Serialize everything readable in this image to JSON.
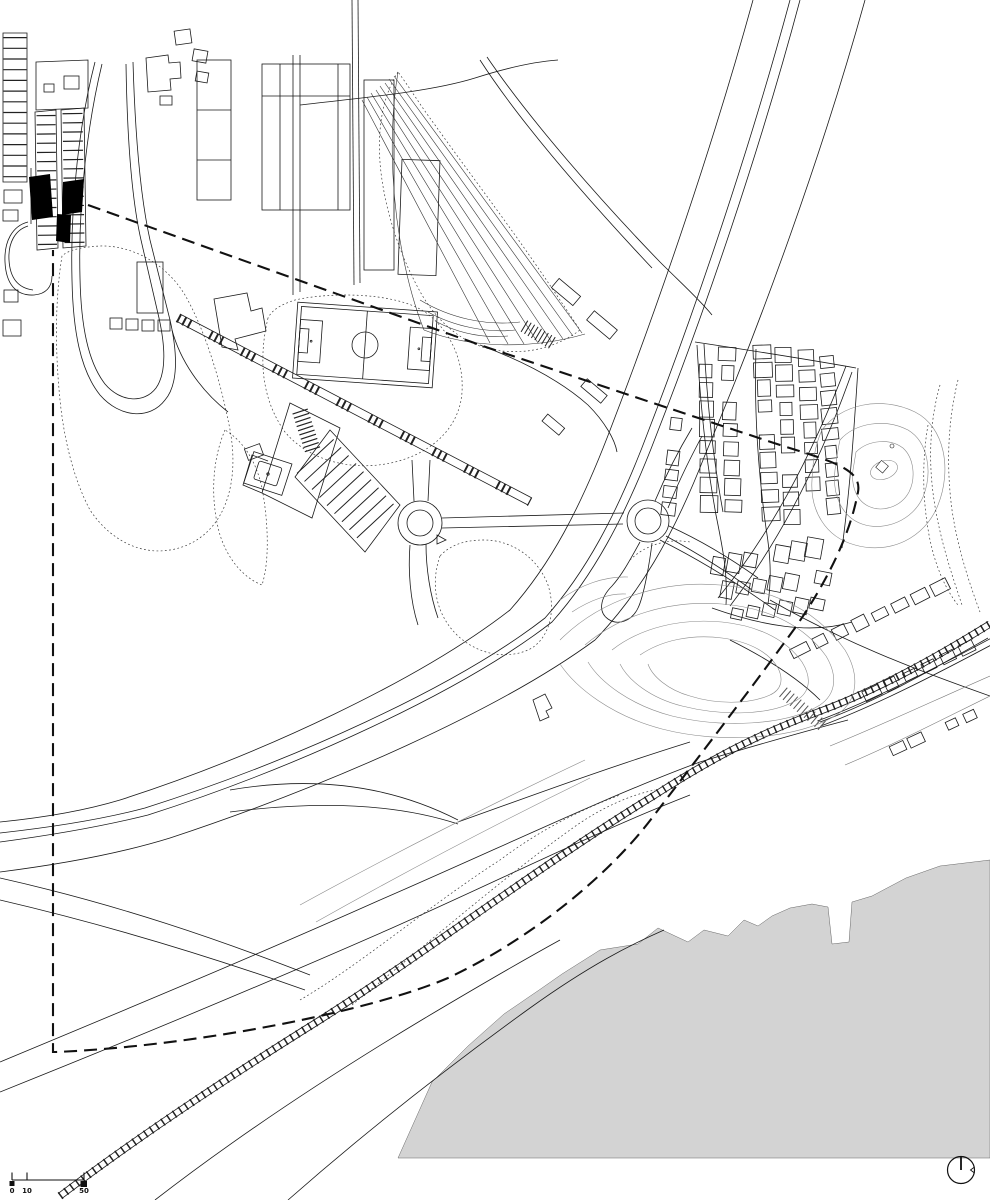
{
  "drawing": {
    "kind": "architectural urban site plan",
    "colors": {
      "background": "#ffffff",
      "linework": "#1a1a1a",
      "contours": "#8a8a8a",
      "water": "#d3d3d3",
      "site_fill": "#000000",
      "dashed_boundary": "#111111",
      "vegetation": "#3a3a3a"
    }
  },
  "scale_bar": {
    "tick_labels": [
      "0",
      "10",
      "50"
    ]
  },
  "icons": {
    "north_indicator": "circle-with-north-needle"
  }
}
